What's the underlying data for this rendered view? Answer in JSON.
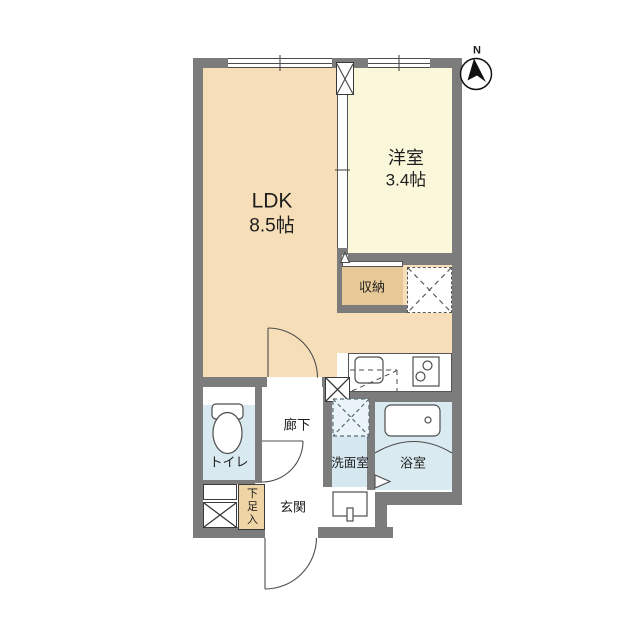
{
  "plan_title": "1LDK apartment floor plan",
  "compass": {
    "north_label": "N"
  },
  "rooms": [
    {
      "id": "ldk",
      "name": "LDK",
      "size": "8.5帖"
    },
    {
      "id": "western",
      "name": "洋室",
      "size": "3.4帖"
    },
    {
      "id": "closet",
      "name": "収納",
      "size": ""
    },
    {
      "id": "toilet",
      "name": "トイレ",
      "size": ""
    },
    {
      "id": "hallway",
      "name": "廊下",
      "size": ""
    },
    {
      "id": "washroom",
      "name": "洗面室",
      "size": ""
    },
    {
      "id": "bathroom",
      "name": "浴室",
      "size": ""
    },
    {
      "id": "entrance",
      "name": "玄関",
      "size": ""
    },
    {
      "id": "shoebox",
      "name": "下足入",
      "size": ""
    }
  ],
  "icons": [
    "north-arrow-icon",
    "toilet-icon",
    "bathtub-icon",
    "washbasin-icon",
    "kitchen-sink-icon",
    "stove-icon",
    "washing-machine-pan-icon",
    "fridge-space-icon",
    "pipe-space-icon",
    "meter-box-icon",
    "door-swing-icon",
    "sliding-door-icon",
    "window-icon"
  ],
  "colors": {
    "wall": "#7c7c7c",
    "ldk_floor": "#F6DFB8",
    "western_room_floor": "#FBF7DB",
    "closet_floor": "#E6C997",
    "shoebox_fill": "#EFD4A6",
    "wet_area_floor": "#D9EAF1",
    "line": "#4d4d4d",
    "text": "#1e1e1e"
  }
}
